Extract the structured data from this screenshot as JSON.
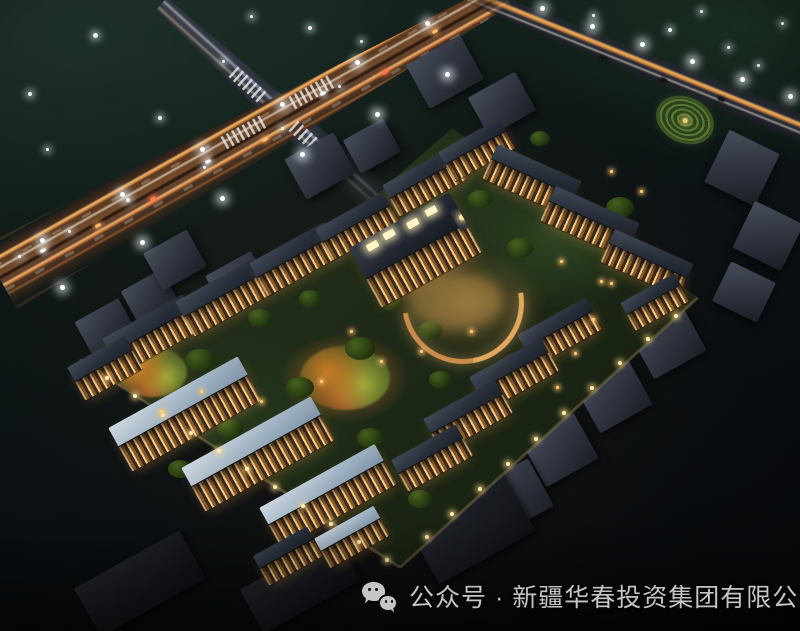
{
  "caption": {
    "icon": "wechat-icon",
    "text": "公众号 · 新疆华春投资集团有限公司"
  },
  "scene": {
    "subject": "aerial night rendering of a residential community",
    "features": [
      "illuminated highway with intersection",
      "tree-lined boundary road with street lamps",
      "low-rise residential rows with lit facades",
      "central clubhouse with curved plaza",
      "spiral landscaped garden",
      "unlit surrounding context buildings",
      "perimeter wall lights"
    ]
  },
  "colors": {
    "night_sky": "#0b1013",
    "foliage": "#24361c",
    "road_glow": "#f2a75c",
    "facade_windows": "#f6cd88",
    "roof_dark": "#29303b",
    "roof_light": "#9db0c0",
    "context_block": "#313641",
    "caption_text": "#c5c5c7"
  }
}
